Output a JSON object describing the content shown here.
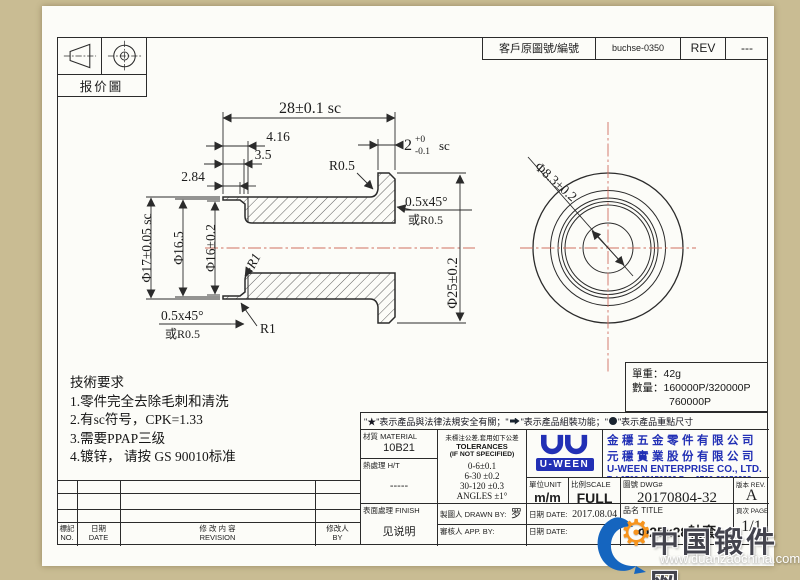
{
  "header": {
    "customer_no_label": "客戶原圖號/編號",
    "customer_no": "buchse-0350",
    "rev_label": "REV",
    "rev_value": "---"
  },
  "stamp": {
    "label": "报价圖"
  },
  "dims": {
    "len28": "28±0.1 sc",
    "d416": "4.16",
    "d35": "3.5",
    "d284": "2.84",
    "flange_val": "2",
    "flange_up": "+0",
    "flange_dn": "-0.1",
    "flange_sc": "sc",
    "r05": "R0.5",
    "cham_right": "0.5x45°",
    "cham_right_alt": "或R0.5",
    "cham_left": "0.5x45°",
    "cham_left_alt": "或R0.5",
    "d17": "Φ17±0.05 sc",
    "d165": "Φ16.5",
    "d16": "Φ16±0.2",
    "d25": "Φ25±0.2",
    "r1a": "R1",
    "r1b": "R1",
    "d83": "Φ8.3±0.2"
  },
  "notes": {
    "title": "技術要求",
    "items": [
      "1.零件完全去除毛刺和清洗",
      "2.有sc符号，CPK=1.33",
      "3.需要PPAP三级",
      "4.镀锌， 请按 GS 90010标准"
    ]
  },
  "qty": {
    "weight": "單重：42g",
    "line1": "數量：160000P/320000P",
    "line2": "760000P"
  },
  "legend": {
    "p1": "\"★\"表示產品與法律法規安全有關；\"",
    "p2": "\"表示產品組裝功能；\"",
    "p3": "\"表示產品重點尺寸"
  },
  "titleblock": {
    "material_label": "材質 MATERIAL",
    "material": "10B21",
    "ht_label": "熱處理 H/T",
    "ht": "-----",
    "finish_label": "表面處理 FINISH",
    "finish": "见说明",
    "tol": {
      "l1": "未標注公差,套用如下公差",
      "l2": "TOLERANCES",
      "l3": "(IF NOT SPECIFIED)",
      "l4": "0-6±0.1",
      "l5": "6-30 ±0.2",
      "l6": "30-120 ±0.3",
      "l7": "ANGLES ±1°"
    },
    "logo_text": "U-WEEN",
    "company": {
      "cn1": "金穩五金零件有限公司",
      "cn2": "元穩實業股份有限公司",
      "en": "U-WEEN ENTERPRISE CO., LTD.",
      "tel": "Tel:0760-28156999 Fax:0760-28156998"
    },
    "unit_label": "單位UNIT",
    "unit": "m/m",
    "scale_label": "比例SCALE",
    "scale": "FULL",
    "dwg_label": "圖號 DWG#",
    "dwg": "20170804-32",
    "rev_label": "版本 REV.",
    "rev": "A",
    "drawn_label": "製圖人 DRAWN BY:",
    "drawn": "罗教堂",
    "app_label": "審核人 APP. BY:",
    "date_label": "日期 DATE:",
    "date": "2017.08.04",
    "date2_label": "日期 DATE:",
    "title_label": "品名 TITLE",
    "title": "Φ25x28轴套",
    "page_label": "頁次 PAGE",
    "page": "1/1"
  },
  "revision_table": {
    "no": "標記",
    "no_en": "NO.",
    "date": "日期",
    "date_en": "DATE",
    "content": "修 改 内 容",
    "content_en": "REVISION",
    "by": "修改人",
    "by_en": "BY"
  },
  "watermark": {
    "name": "中国锻件网",
    "url": "www.duanzaochina.com"
  }
}
